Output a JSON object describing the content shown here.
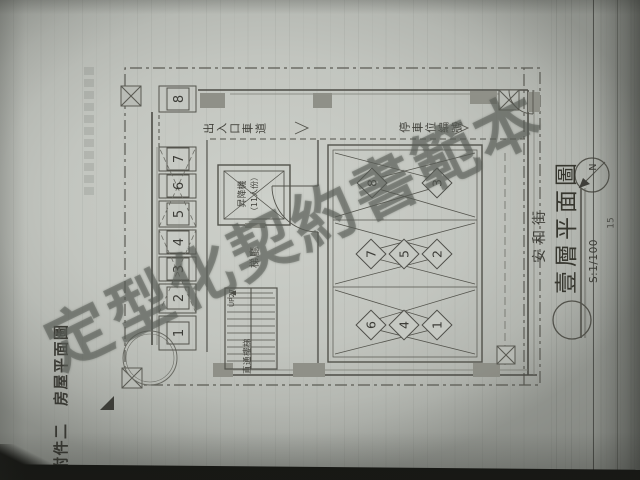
{
  "page": {
    "attachment_title": "附件二　房屋平面圖",
    "page_number": "15"
  },
  "watermark": {
    "text": "定型化契約書範本"
  },
  "plan": {
    "labels": {
      "driveway": "出入口車道",
      "elevator": "昇降機",
      "elevator_capacity": "（11人份）",
      "elevator_hall": "梯廳",
      "stairs_up": "UP27",
      "direct_stairs": "直通樓梯",
      "parking_number_label": "停車位編號",
      "street": "安和街",
      "north": "N"
    },
    "moto_stalls": [
      "1",
      "2",
      "3",
      "4",
      "5",
      "6",
      "7",
      "8"
    ],
    "car_stalls": [
      "1",
      "2",
      "3",
      "4",
      "5",
      "6",
      "7",
      "8"
    ],
    "title_block": {
      "title": "壹層平面圖",
      "scale": "S:1/100"
    }
  }
}
